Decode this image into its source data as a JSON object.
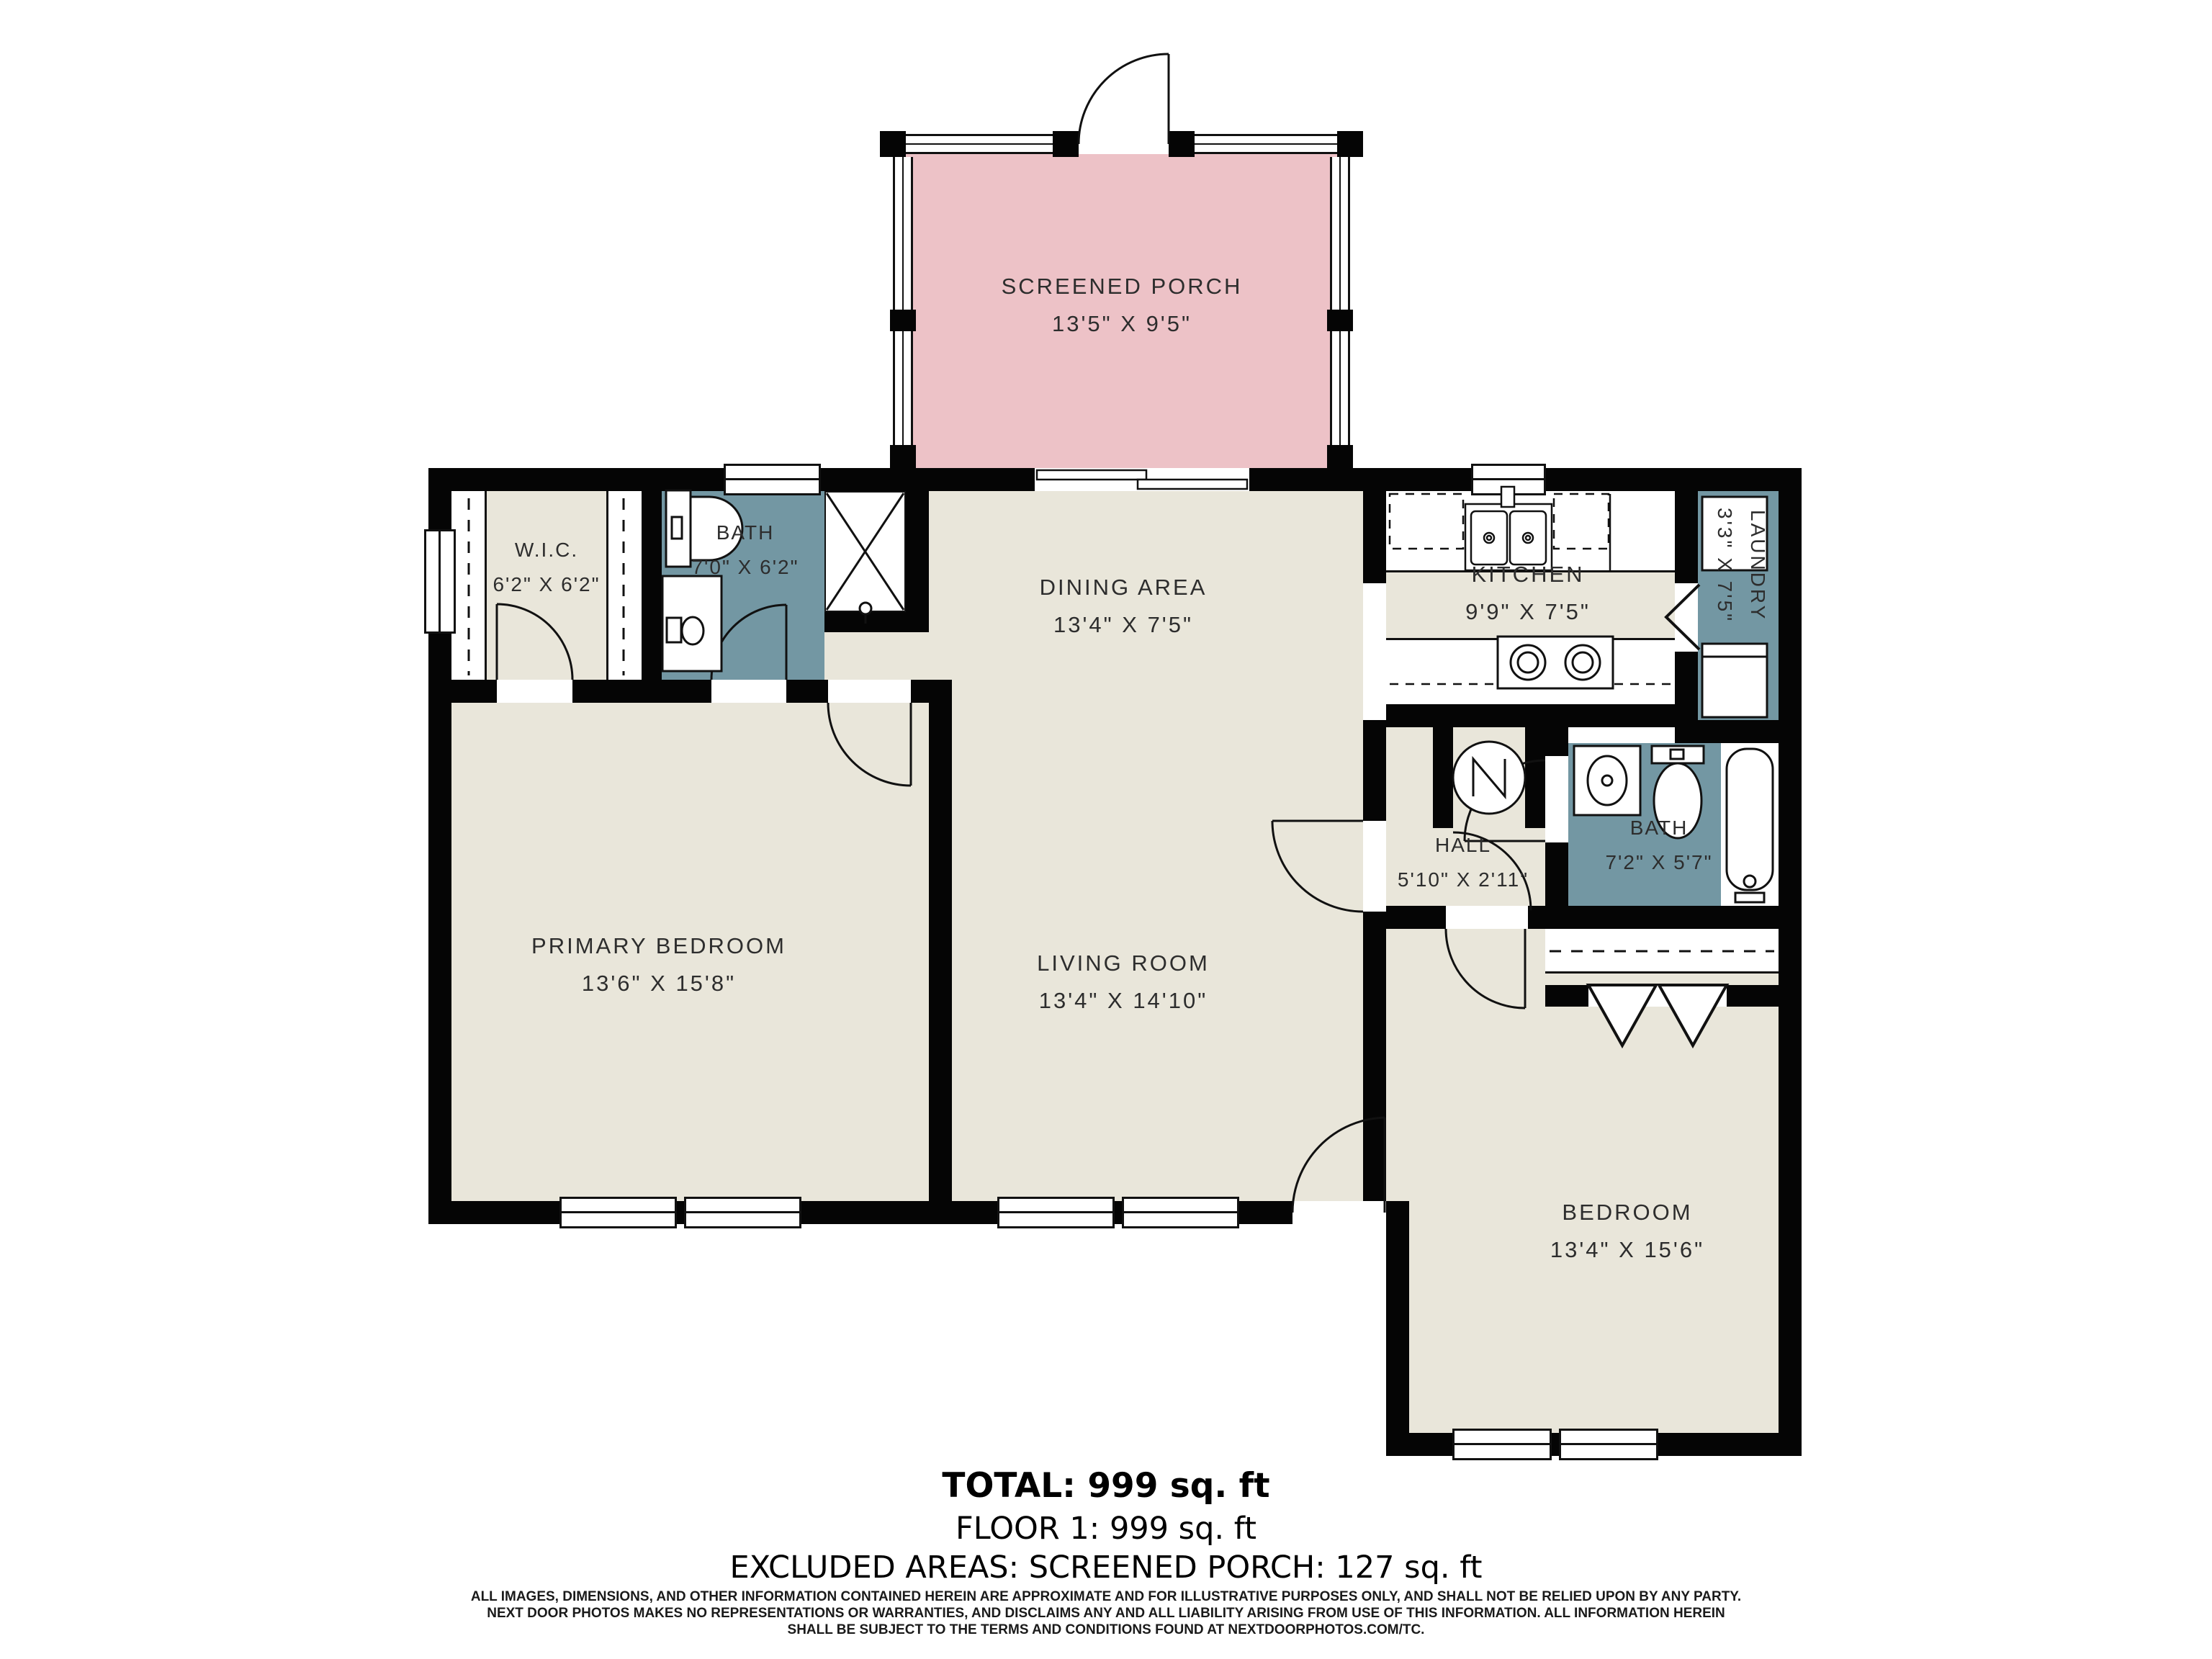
{
  "rooms": [
    {
      "id": "screened-porch",
      "name": "SCREENED PORCH",
      "dims": "13'5\" X 9'5\""
    },
    {
      "id": "wic",
      "name": "W.I.C.",
      "dims": "6'2\" X 6'2\""
    },
    {
      "id": "bath-top",
      "name": "BATH",
      "dims": "7'0\" X 6'2\""
    },
    {
      "id": "dining-area",
      "name": "DINING AREA",
      "dims": "13'4\" X 7'5\""
    },
    {
      "id": "kitchen",
      "name": "KITCHEN",
      "dims": "9'9\" X 7'5\""
    },
    {
      "id": "laundry",
      "name": "LAUNDRY",
      "dims": "3'3\" X 7'5\""
    },
    {
      "id": "primary-bedroom",
      "name": "PRIMARY BEDROOM",
      "dims": "13'6\" X 15'8\""
    },
    {
      "id": "living-room",
      "name": "LIVING ROOM",
      "dims": "13'4\" X 14'10\""
    },
    {
      "id": "hall",
      "name": "HALL",
      "dims": "5'10\" X 2'11\""
    },
    {
      "id": "bath-right",
      "name": "BATH",
      "dims": "7'2\" X 5'7\""
    },
    {
      "id": "bedroom",
      "name": "BEDROOM",
      "dims": "13'4\" X 15'6\""
    }
  ],
  "summary": {
    "total": "TOTAL: 999 sq. ft",
    "floor": "FLOOR 1: 999 sq. ft",
    "excluded": "EXCLUDED AREAS: SCREENED PORCH: 127 sq. ft"
  },
  "disclaimer": [
    "ALL IMAGES, DIMENSIONS, AND OTHER INFORMATION CONTAINED HEREIN ARE APPROXIMATE AND FOR ILLUSTRATIVE PURPOSES ONLY, AND SHALL NOT BE RELIED UPON BY ANY PARTY.",
    "NEXT DOOR PHOTOS MAKES NO REPRESENTATIONS OR WARRANTIES, AND DISCLAIMS ANY AND ALL LIABILITY ARISING FROM USE OF THIS INFORMATION. ALL INFORMATION HEREIN",
    "SHALL BE SUBJECT TO THE TERMS AND CONDITIONS FOUND AT NEXTDOORPHOTOS.COM/TC."
  ],
  "colors": {
    "wall": "#050505",
    "floor": "#e9e6da",
    "wet": "#7397a3",
    "porch": "#edc2c7",
    "line": "#111111"
  }
}
